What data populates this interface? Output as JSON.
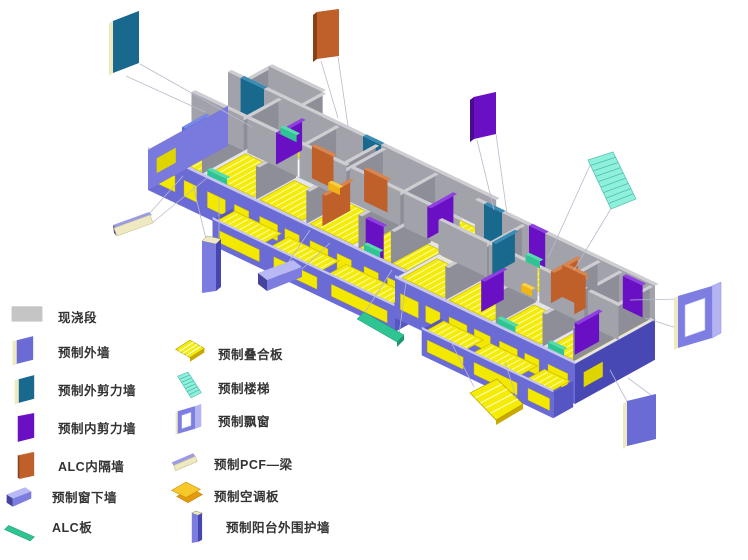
{
  "legend": {
    "column1": [
      {
        "label": "现浇段",
        "icon": "cast-segment",
        "color": "#c5c5c5"
      },
      {
        "label": "预制外墙",
        "icon": "ext-wall",
        "color": "#6b6bd6"
      },
      {
        "label": "预制外剪力墙",
        "icon": "ext-shear-wall",
        "color": "#19688e"
      },
      {
        "label": "预制内剪力墙",
        "icon": "int-shear-wall",
        "color": "#6a10c4"
      },
      {
        "label": "ALC内隔墙",
        "icon": "alc-partition",
        "color": "#bf5f2a"
      },
      {
        "label": "预制窗下墙",
        "icon": "under-window-wall",
        "color": "#a0a0ec"
      },
      {
        "label": "ALC板",
        "icon": "alc-panel",
        "color": "#2fc493"
      }
    ],
    "column2": [
      {
        "label": "预制叠合板",
        "icon": "composite-slab",
        "color": "#f4ec04"
      },
      {
        "label": "预制楼梯",
        "icon": "stairs",
        "color": "#8ff0dc"
      },
      {
        "label": "预制飘窗",
        "icon": "bay-window",
        "color": "#7e7ee2"
      },
      {
        "label": "预制PCF—梁",
        "icon": "pcf-beam",
        "color": "#efe9c2"
      },
      {
        "label": "预制空调板",
        "icon": "aircon-slab",
        "color": "#f0b414"
      },
      {
        "label": "预制阳台外围护墙",
        "icon": "balcony-wall",
        "color": "#6e6ed8"
      }
    ]
  },
  "palette": {
    "wallGrayFace": "#a2a2aa",
    "wallGraySide": "#8e8e98",
    "wallTop": "#cdcdd2",
    "slabYellow": "#f4ec04",
    "slabEdge": "#c9b400",
    "bandBlue": "#6b6bd6",
    "bandBlueLight": "#7a7ade",
    "bandBlueDark": "#4848b4",
    "bandTopStrip": "#c6c6f0",
    "windowYellow": "#f2e800",
    "stairCyan": "#8ff0dc",
    "stairStripe": "#4fbfae",
    "teal": "#19688e",
    "purple": "#6a10c4",
    "orange": "#bf5f2a",
    "green": "#2fc493",
    "gold": "#f0b414",
    "periwinkle": "#a0a0ec",
    "cream": "#efe9c2",
    "leader": "#b9b9cf",
    "base": "#e4e4ea",
    "legendGray": "#c5c5c5",
    "text": "#333333"
  },
  "building": {
    "wings": [
      {
        "origin": [
          148,
          150
        ],
        "len": 298,
        "dep": 92,
        "bandH": 40,
        "wallH": 34,
        "leftEnd": true,
        "rightEnd": false,
        "protrusion": [
          18,
          92,
          78,
          120
        ],
        "whiteRooms": [
          [
            100,
            50,
            122,
            90
          ],
          [
            168,
            46,
            176,
            90
          ]
        ],
        "yellowRooms": [
          [
            4,
            4,
            56,
            44
          ],
          [
            4,
            50,
            56,
            88
          ],
          [
            62,
            4,
            114,
            48
          ],
          [
            62,
            54,
            98,
            88
          ],
          [
            120,
            4,
            168,
            44
          ],
          [
            176,
            4,
            224,
            48
          ],
          [
            176,
            54,
            220,
            88
          ],
          [
            230,
            4,
            292,
            44
          ],
          [
            236,
            50,
            292,
            88
          ]
        ],
        "stairs": [
          [
            122,
            48,
            164,
            90
          ]
        ],
        "grayU": [
          [
            0,
            298,
            92
          ],
          [
            0,
            58,
            50
          ],
          [
            62,
            118,
            50
          ],
          [
            120,
            172,
            50
          ],
          [
            176,
            232,
            50
          ],
          [
            236,
            298,
            50
          ]
        ],
        "grayV": [
          [
            2,
            90,
            58
          ],
          [
            2,
            48,
            118
          ],
          [
            48,
            90,
            166
          ],
          [
            2,
            90,
            174
          ],
          [
            2,
            90,
            232
          ],
          [
            2,
            48,
            268
          ],
          [
            50,
            90,
            122
          ]
        ],
        "colorU": [
          [
            14,
            40,
            92,
            "teal"
          ],
          [
            150,
            170,
            92,
            "teal"
          ],
          [
            238,
            258,
            4,
            "purple"
          ],
          [
            184,
            210,
            58,
            "orange"
          ],
          [
            128,
            152,
            56,
            "orange"
          ]
        ],
        "colorV": [
          [
            52,
            82,
            92,
            "purple"
          ],
          [
            50,
            80,
            262,
            "purple"
          ],
          [
            8,
            40,
            186,
            "orange"
          ],
          [
            8,
            36,
            30,
            "blueInt"
          ]
        ],
        "lowU": [
          [
            64,
            86,
            2,
            "green"
          ],
          [
            238,
            256,
            2,
            "green"
          ],
          [
            62,
            80,
            88,
            "green"
          ],
          [
            150,
            163,
            52,
            "gold"
          ]
        ],
        "windows": [
          [
            8,
            30
          ],
          [
            40,
            54
          ],
          [
            66,
            86
          ],
          [
            96,
            112
          ],
          [
            124,
            144
          ],
          [
            152,
            168
          ],
          [
            180,
            200
          ],
          [
            210,
            226
          ],
          [
            240,
            256
          ],
          [
            266,
            288
          ]
        ],
        "balcony": {
          "u0": 94,
          "u1": 296,
          "slabs": [
            [
              98,
              150
            ],
            [
              158,
              214
            ],
            [
              222,
              292
            ]
          ],
          "windows": [
            [
              102,
              146
            ],
            [
              162,
              210
            ],
            [
              226,
              288
            ]
          ]
        }
      },
      {
        "origin": [
          395,
          278
        ],
        "len": 200,
        "dep": 92,
        "bandH": 40,
        "wallH": 34,
        "leftEnd": false,
        "rightEnd": true,
        "whiteRooms": [
          [
            104,
            50,
            132,
            90
          ],
          [
            14,
            54,
            50,
            88
          ]
        ],
        "yellowRooms": [
          [
            4,
            4,
            50,
            44
          ],
          [
            4,
            50,
            46,
            88
          ],
          [
            56,
            4,
            104,
            48
          ],
          [
            58,
            54,
            100,
            88
          ],
          [
            112,
            4,
            158,
            44
          ],
          [
            166,
            4,
            196,
            48
          ],
          [
            164,
            54,
            196,
            88
          ]
        ],
        "stairs": [
          [
            132,
            50,
            170,
            88
          ],
          [
            18,
            58,
            48,
            86
          ]
        ],
        "grayU": [
          [
            0,
            200,
            92
          ],
          [
            0,
            54,
            50
          ],
          [
            56,
            110,
            50
          ],
          [
            112,
            162,
            50
          ],
          [
            166,
            200,
            50
          ]
        ],
        "grayV": [
          [
            2,
            90,
            54
          ],
          [
            2,
            48,
            110
          ],
          [
            2,
            90,
            162
          ],
          [
            2,
            90,
            196
          ],
          [
            50,
            90,
            138
          ]
        ],
        "colorU": [
          [
            10,
            30,
            92,
            "teal"
          ],
          [
            120,
            146,
            68,
            "orange"
          ],
          [
            168,
            190,
            88,
            "purple"
          ],
          [
            60,
            78,
            92,
            "purple"
          ]
        ],
        "colorV": [
          [
            55,
            86,
            120,
            "orange"
          ],
          [
            55,
            68,
            146,
            "orange"
          ],
          [
            8,
            34,
            88,
            "purple"
          ],
          [
            10,
            38,
            190,
            "purple"
          ],
          [
            56,
            82,
            54,
            "teal"
          ]
        ],
        "lowU": [
          [
            112,
            132,
            2,
            "green"
          ],
          [
            168,
            186,
            2,
            "green"
          ],
          [
            60,
            76,
            88,
            "green"
          ],
          [
            90,
            102,
            52,
            "gold"
          ]
        ],
        "windows": [
          [
            6,
            26
          ],
          [
            34,
            50
          ],
          [
            60,
            80
          ],
          [
            88,
            106
          ],
          [
            116,
            136
          ],
          [
            144,
            160
          ],
          [
            170,
            192
          ]
        ],
        "balcony": {
          "u0": 52,
          "u1": 198,
          "slabs": [
            [
              56,
              100
            ],
            [
              108,
              160
            ],
            [
              168,
              196
            ]
          ],
          "windows": [
            [
              58,
              98
            ],
            [
              110,
              158
            ],
            [
              170,
              194
            ]
          ]
        }
      }
    ]
  },
  "callouts": [
    {
      "name": "ext-shear-wall",
      "type": "panel",
      "x": 113,
      "y": 21,
      "w": 26,
      "h": 52,
      "skew": -10,
      "face": "#19688e",
      "top": "#2090d8",
      "side": "#efe9c2",
      "leaders": [
        [
          126,
          76,
          205,
          112
        ],
        [
          140,
          64,
          252,
          127
        ]
      ]
    },
    {
      "name": "alc-partition",
      "type": "panel",
      "x": 317,
      "y": 12,
      "w": 22,
      "h": 47,
      "skew": -3,
      "face": "#bf5f2a",
      "top": "#d8854f",
      "side": "#8a3f16",
      "leaders": [
        [
          321,
          61,
          338,
          118
        ],
        [
          338,
          57,
          348,
          126
        ]
      ]
    },
    {
      "name": "int-shear-wall",
      "type": "panel",
      "x": 474,
      "y": 97,
      "w": 22,
      "h": 42,
      "skew": -5,
      "face": "#6a10c4",
      "top": "#9040e0",
      "side": "#4a0b90",
      "leaders": [
        [
          477,
          140,
          494,
          210
        ],
        [
          496,
          134,
          507,
          214
        ]
      ]
    },
    {
      "name": "ext-wall",
      "type": "panel",
      "x": 627,
      "y": 401,
      "w": 29,
      "h": 45,
      "skew": -7,
      "face": "#6b6bd6",
      "top": "#a8a8f0",
      "side": "#efe9c2",
      "leaders": [
        [
          629,
          405,
          610,
          370
        ],
        [
          655,
          398,
          628,
          378
        ]
      ]
    },
    {
      "name": "stairs",
      "type": "stairs",
      "leaders": [
        [
          591,
          163,
          548,
          258
        ],
        [
          612,
          207,
          574,
          270
        ]
      ]
    },
    {
      "name": "bay-window",
      "type": "window",
      "leaders": [
        [
          683,
          299,
          630,
          300
        ],
        [
          683,
          330,
          645,
          318
        ]
      ]
    },
    {
      "name": "composite-slab",
      "type": "slab",
      "leaders": [
        [
          474,
          387,
          450,
          340
        ],
        [
          520,
          409,
          505,
          362
        ]
      ]
    },
    {
      "name": "alc-panel",
      "type": "bar",
      "leaders": [
        [
          362,
          317,
          392,
          270
        ],
        [
          399,
          335,
          406,
          282
        ]
      ]
    },
    {
      "name": "under-window-wall",
      "type": "sill-beam",
      "leaders": [
        [
          288,
          263,
          310,
          230
        ],
        [
          300,
          271,
          330,
          243
        ]
      ]
    },
    {
      "name": "balcony-wall",
      "type": "column",
      "leaders": [
        [
          206,
          239,
          193,
          185
        ],
        [
          219,
          238,
          219,
          198
        ]
      ]
    },
    {
      "name": "pcf-beam",
      "type": "pcf",
      "leaders": [
        [
          148,
          215,
          183,
          176
        ],
        [
          152,
          223,
          207,
          178
        ]
      ]
    }
  ]
}
